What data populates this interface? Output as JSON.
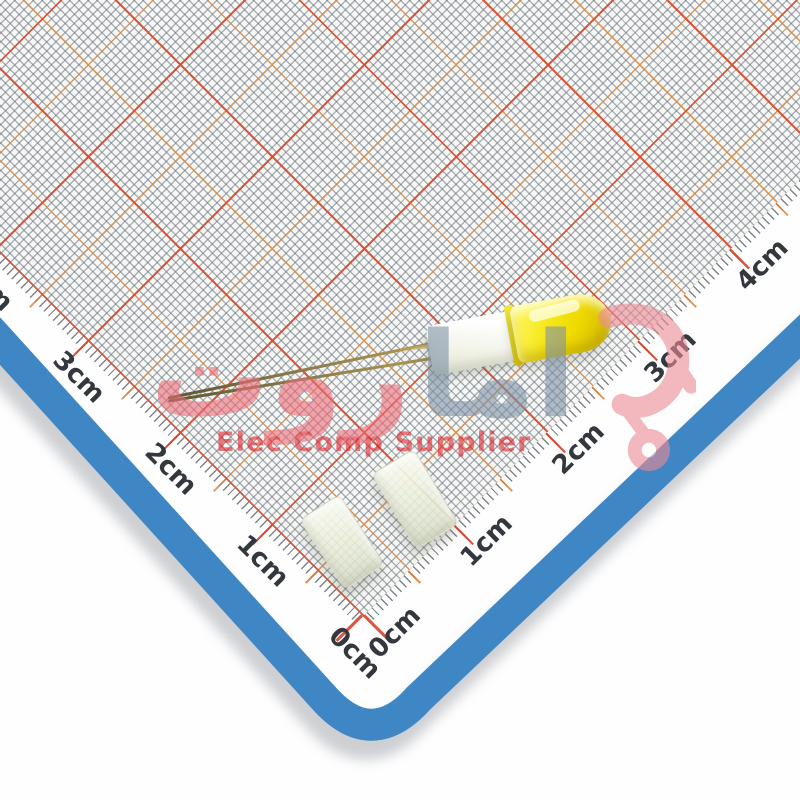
{
  "rulers": {
    "left": {
      "labels": [
        "0cm",
        "1cm",
        "2cm",
        "3cm",
        "4cm"
      ]
    },
    "right": {
      "labels": [
        "0cm",
        "1cm",
        "2cm",
        "3cm",
        "4cm"
      ]
    }
  },
  "watermark": {
    "arabic_gray": "اما",
    "arabic_pink": "روت",
    "tagline": "Elec Comp Supplier",
    "icon": "cart-logo-icon"
  },
  "colors": {
    "mat_border_blue": "#3f86c4",
    "grid_cm_red": "#d84a32",
    "grid_half_cm_orange": "#e98d3e",
    "grid_fine_gray": "#6a7580",
    "led_yellow": "#f2de00",
    "spacer_white": "#eef0e2",
    "watermark_pink": "#ec6b77",
    "watermark_gray": "#7e92a6",
    "tagline_red": "#e22128"
  }
}
